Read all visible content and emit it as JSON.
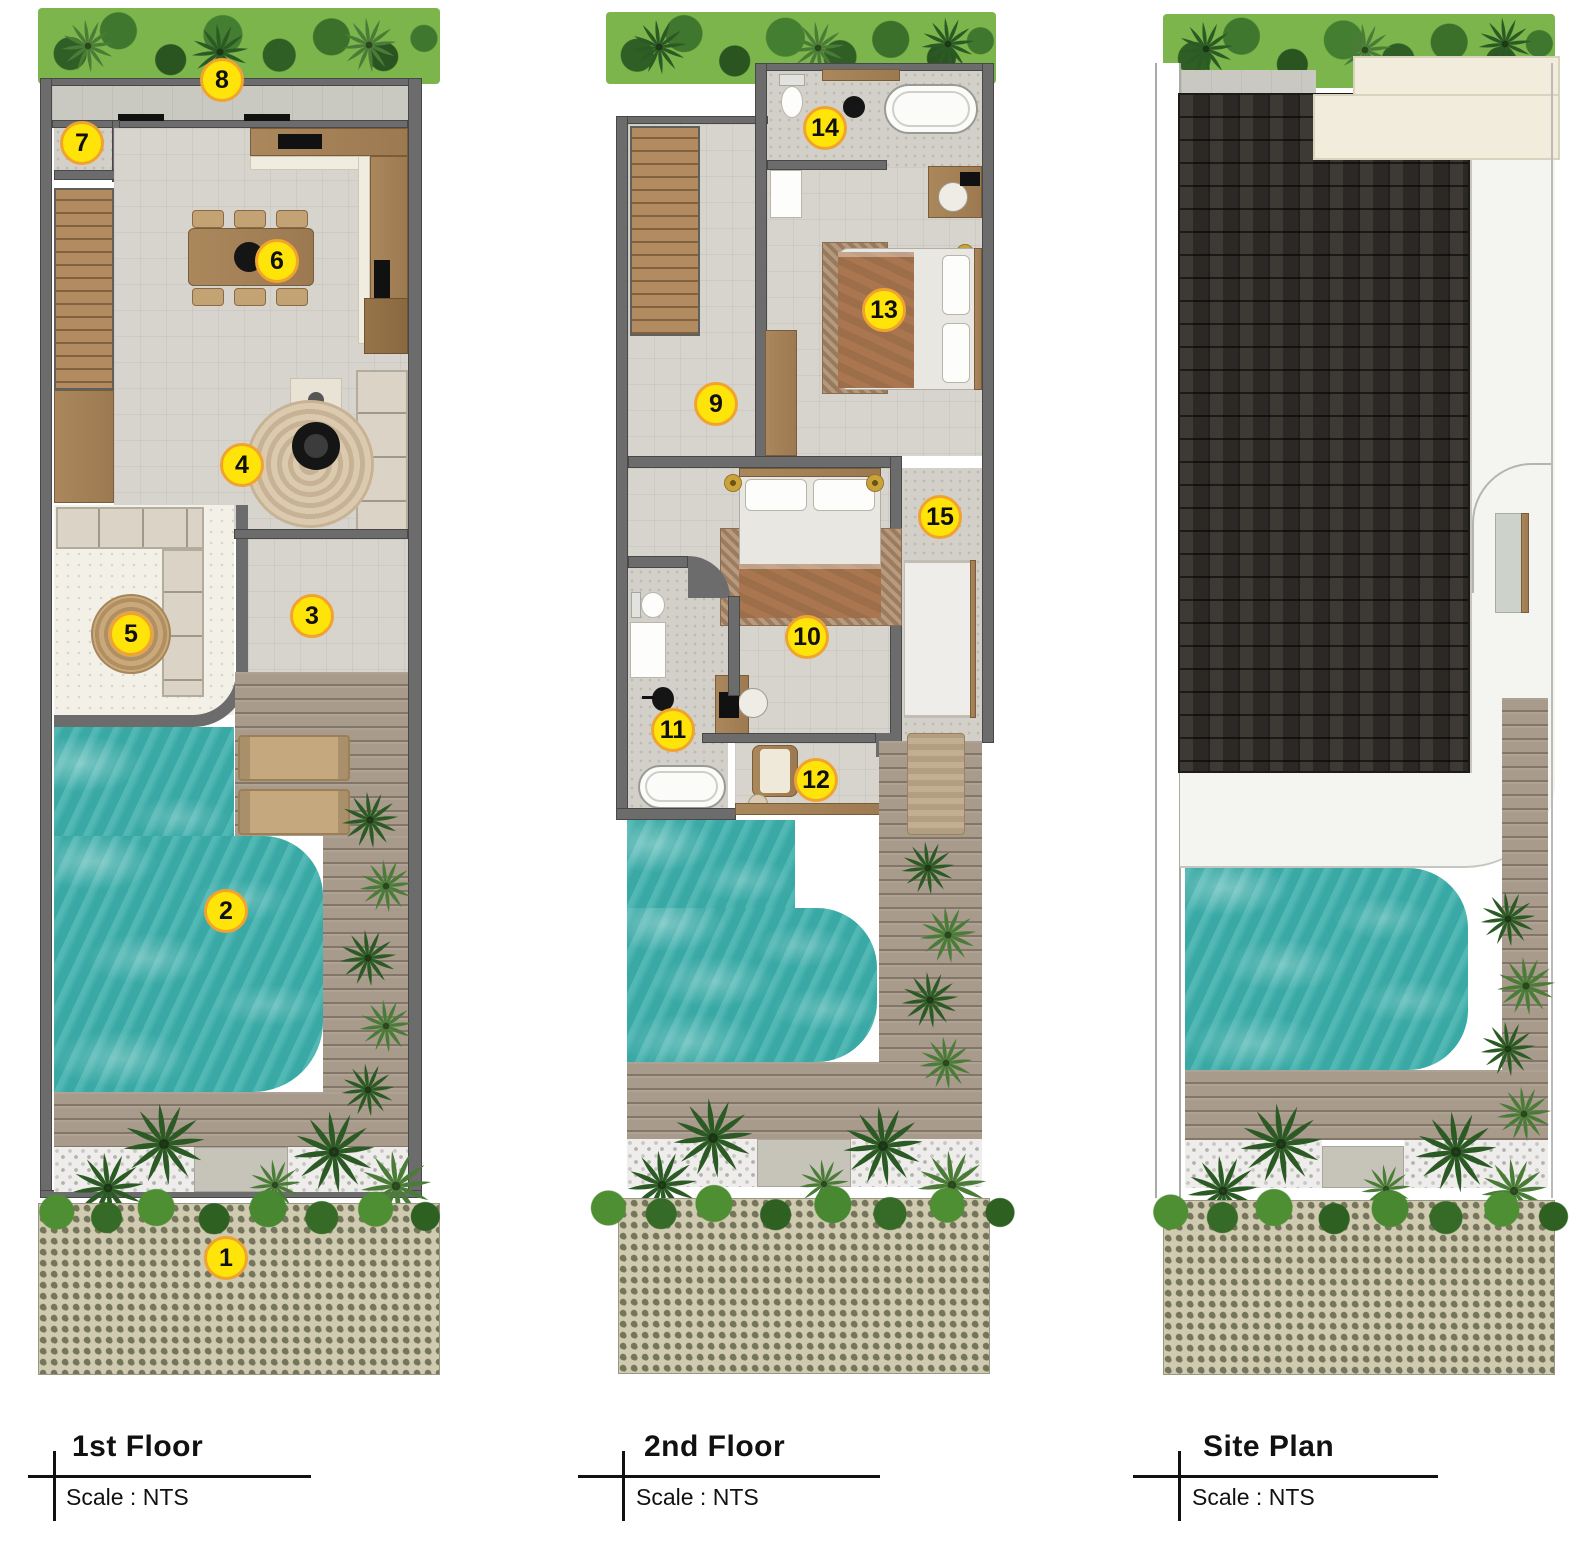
{
  "sheet": {
    "type": "architectural-floorplan",
    "panels": 3
  },
  "panels": [
    {
      "title": "1st Floor",
      "scale_label": "Scale : NTS",
      "marker_numbers": [
        "1",
        "2",
        "3",
        "4",
        "5",
        "6",
        "7",
        "8"
      ]
    },
    {
      "title": "2nd Floor",
      "scale_label": "Scale : NTS",
      "marker_numbers": [
        "9",
        "10",
        "11",
        "12",
        "13",
        "14",
        "15"
      ]
    },
    {
      "title": "Site Plan",
      "scale_label": "Scale : NTS",
      "marker_numbers": []
    }
  ],
  "markers": {
    "m1": "1",
    "m2": "2",
    "m3": "3",
    "m4": "4",
    "m5": "5",
    "m6": "6",
    "m7": "7",
    "m8": "8",
    "m9": "9",
    "m10": "10",
    "m11": "11",
    "m12": "12",
    "m13": "13",
    "m14": "14",
    "m15": "15"
  },
  "colors": {
    "marker_fill": "#ffe40a",
    "marker_border": "#f0a32e",
    "pool_water": "#3fb0ac",
    "wall_gray": "#6c6c6c",
    "wood": "#a8855c",
    "deck_wood": "#a89b8c",
    "hedge_green": "#7cb54b",
    "floor_gray": "#d6d4cc",
    "roof_dark": "#332f2b",
    "cream_roof": "#f2ecdc",
    "paver_olive": "#74755a"
  }
}
